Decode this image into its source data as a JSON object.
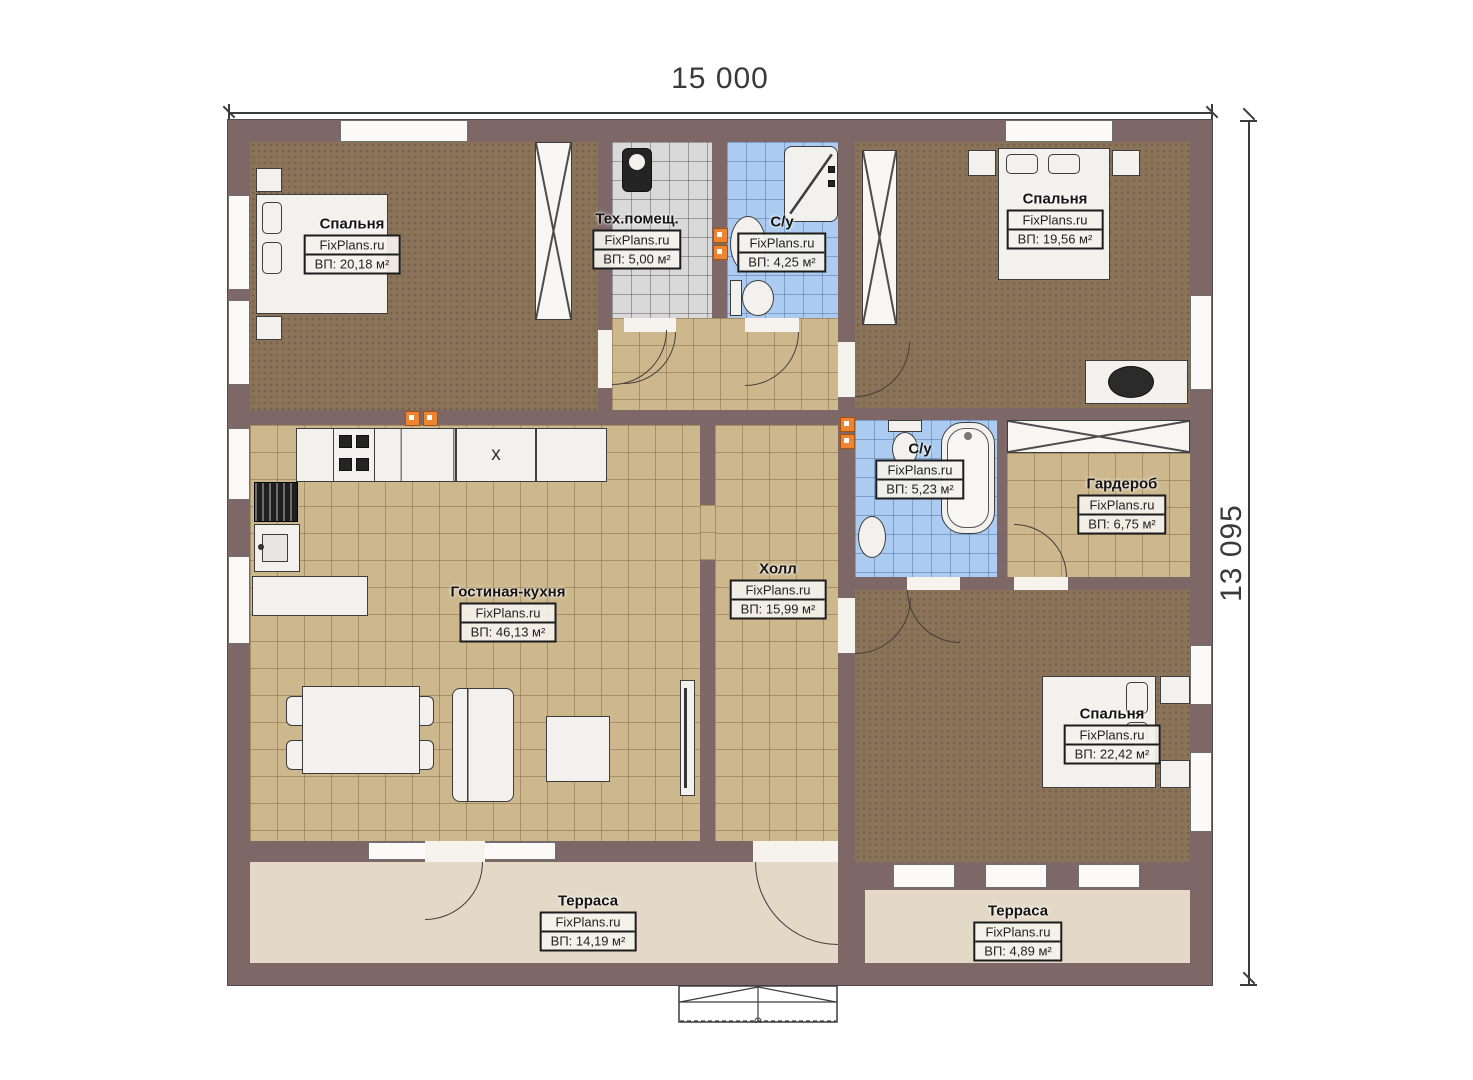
{
  "dimensions": {
    "width_label": "15 000",
    "height_label": "13 095"
  },
  "rooms": {
    "bedroom_top_left": {
      "name": "Спальня",
      "brand": "FixPlans.ru",
      "area": "ВП: 20,18 м²"
    },
    "tech_room": {
      "name": "Тех.помещ.",
      "brand": "FixPlans.ru",
      "area": "ВП: 5,00 м²"
    },
    "bathroom_top": {
      "name": "С/у",
      "brand": "FixPlans.ru",
      "area": "ВП: 4,25 м²"
    },
    "bedroom_top_right": {
      "name": "Спальня",
      "brand": "FixPlans.ru",
      "area": "ВП: 19,56 м²"
    },
    "bathroom_middle": {
      "name": "С/у",
      "brand": "FixPlans.ru",
      "area": "ВП: 5,23 м²"
    },
    "wardrobe": {
      "name": "Гардероб",
      "brand": "FixPlans.ru",
      "area": "ВП: 6,75 м²"
    },
    "living_kitchen": {
      "name": "Гостиная-кухня",
      "brand": "FixPlans.ru",
      "area": "ВП: 46,13 м²"
    },
    "hall": {
      "name": "Холл",
      "brand": "FixPlans.ru",
      "area": "ВП: 15,99 м²"
    },
    "bedroom_bottom_right": {
      "name": "Спальня",
      "brand": "FixPlans.ru",
      "area": "ВП: 22,42 м²"
    },
    "terrace_left": {
      "name": "Терраса",
      "brand": "FixPlans.ru",
      "area": "ВП: 14,19 м²"
    },
    "terrace_right": {
      "name": "Терраса",
      "brand": "FixPlans.ru",
      "area": "ВП: 4,89 м²"
    }
  },
  "kitchen": {
    "appliance_label": "x"
  },
  "colors": {
    "wall": "#7d6767",
    "bedroom_floor": "#8a7358",
    "tile_floor": "#cdb78c",
    "bath_floor": "#abccf0",
    "tech_floor": "#d9d9d9",
    "terrace_floor": "#e4d8c6",
    "socket": "#ef8430"
  }
}
